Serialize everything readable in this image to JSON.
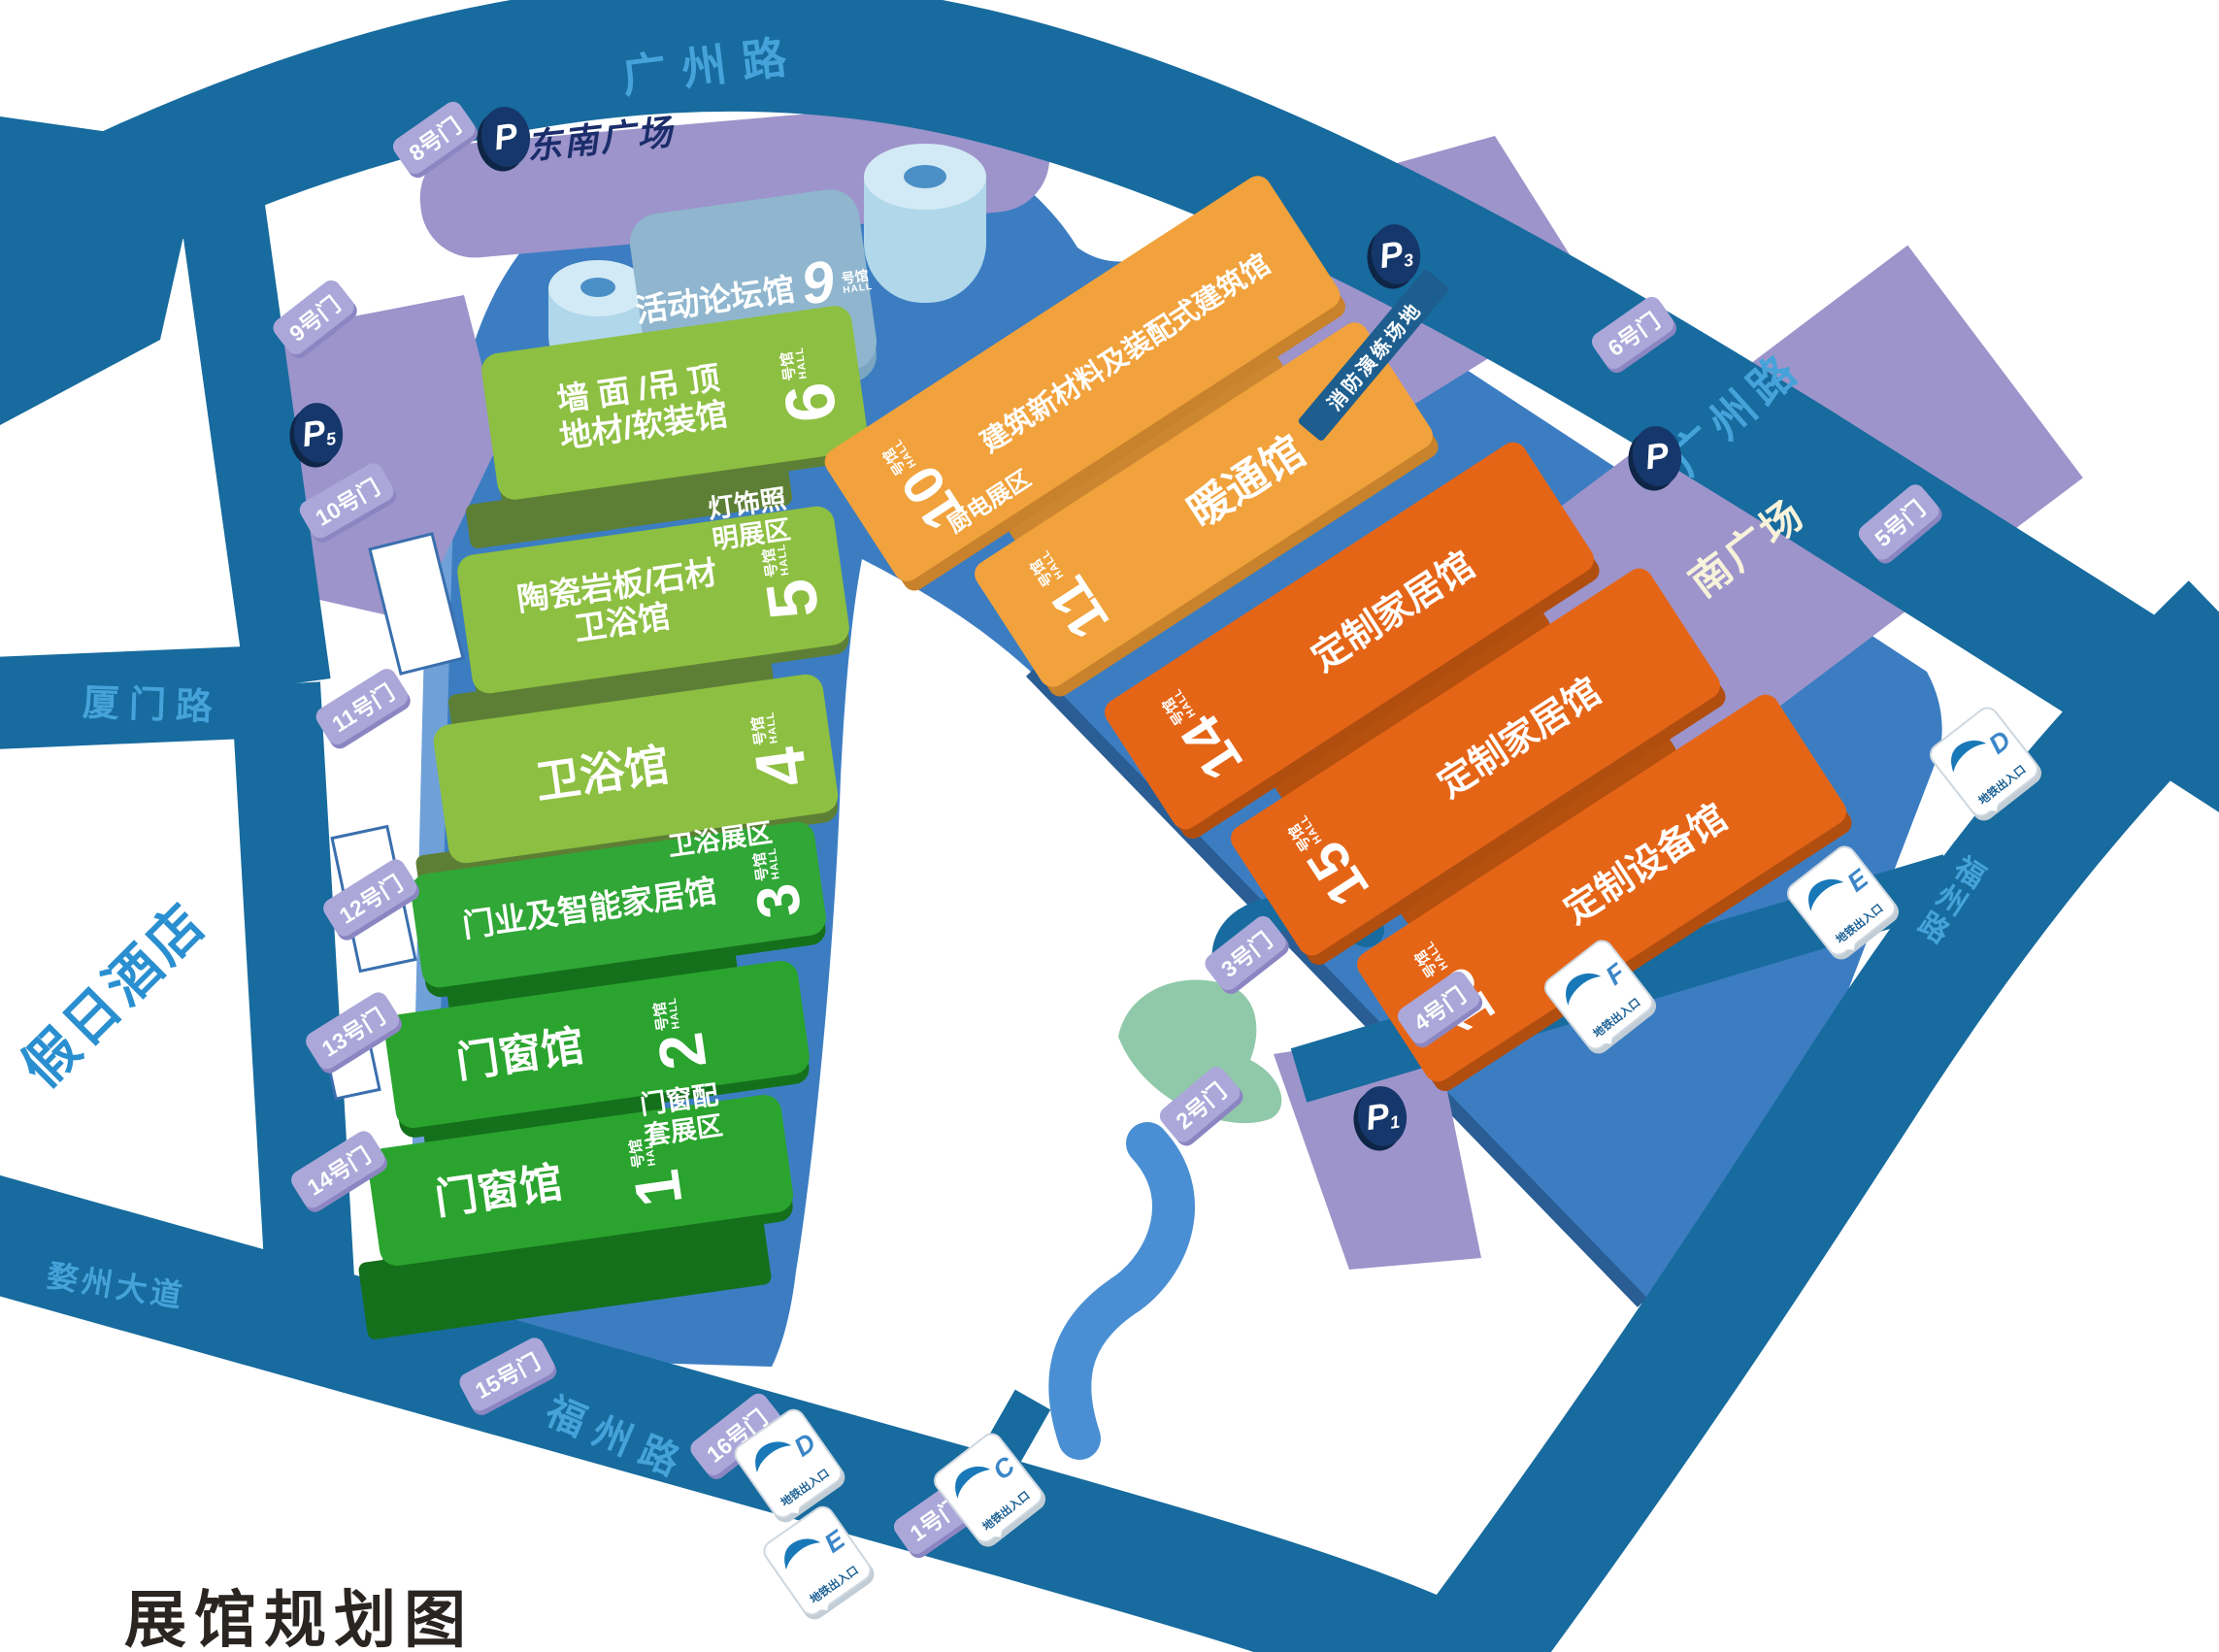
{
  "title": "展馆规划图",
  "roads": {
    "guangzhou_top": "广州路",
    "guangzhou_right": "广州路",
    "xiamen": "厦门路",
    "wuzhou": "婺州大道",
    "fuzhou_bottom": "福州路",
    "fuzhou_right": "福州路"
  },
  "hotel": "假日酒店",
  "plazas": {
    "southeast": "东南广场",
    "south": "南广场",
    "fire_drill": "消防演练场地"
  },
  "parking": [
    {
      "id": "southeast",
      "letter": "P",
      "sub": ""
    },
    {
      "id": "p5",
      "letter": "P",
      "sub": "5"
    },
    {
      "id": "p3",
      "letter": "P",
      "sub": "3"
    },
    {
      "id": "south",
      "letter": "P",
      "sub": ""
    },
    {
      "id": "p1",
      "letter": "P",
      "sub": "1"
    }
  ],
  "hall9": {
    "name": "活动论坛馆",
    "no": "9",
    "unit": "号馆",
    "hall": "HALL"
  },
  "green_halls": [
    {
      "no": "6",
      "unit": "号馆",
      "hall": "HALL",
      "line1": "墙 面 /吊 顶",
      "line2": "地材/软装馆"
    },
    {
      "no": "5",
      "unit": "号馆",
      "hall": "HALL",
      "line1": "陶瓷岩板/石材",
      "line2": "卫浴馆"
    },
    {
      "no": "4",
      "unit": "号馆",
      "hall": "HALL",
      "line1": "卫浴馆",
      "line2": ""
    },
    {
      "no": "3",
      "unit": "号馆",
      "hall": "HALL",
      "line1": "门业及智能家居馆",
      "line2": ""
    },
    {
      "no": "2",
      "unit": "号馆",
      "hall": "HALL",
      "line1": "门窗馆",
      "line2": ""
    },
    {
      "no": "1",
      "unit": "号馆",
      "hall": "HALL",
      "line1": "门窗馆",
      "line2": ""
    }
  ],
  "orange_halls": [
    {
      "no": "10",
      "unit": "号馆",
      "hall": "HALL",
      "name": "建筑新材料及装配式建筑馆"
    },
    {
      "no": "11",
      "unit": "号馆",
      "hall": "HALL",
      "name": "暖通馆"
    },
    {
      "no": "14",
      "unit": "号馆",
      "hall": "HALL",
      "name": "定制家居馆"
    },
    {
      "no": "15",
      "unit": "号馆",
      "hall": "HALL",
      "name": "定制家居馆"
    },
    {
      "no": "16",
      "unit": "号馆",
      "hall": "HALL",
      "name": "定制设备馆"
    }
  ],
  "zones": {
    "lighting1": "灯饰照",
    "lighting2": "明展区",
    "bath": "卫浴展区",
    "window1": "门窗配",
    "window2": "套展区",
    "kitchen": "厨电展区"
  },
  "gates": [
    {
      "label": "1号门"
    },
    {
      "label": "2号门"
    },
    {
      "label": "3号门"
    },
    {
      "label": "4号门"
    },
    {
      "label": "5号门"
    },
    {
      "label": "6号门"
    },
    {
      "label": "8号门"
    },
    {
      "label": "9号门"
    },
    {
      "label": "10号门"
    },
    {
      "label": "11号门"
    },
    {
      "label": "12号门"
    },
    {
      "label": "13号门"
    },
    {
      "label": "14号门"
    },
    {
      "label": "15号门"
    },
    {
      "label": "16号门"
    }
  ],
  "subway": {
    "label": "地铁出入口",
    "entrances": [
      {
        "letter": "D"
      },
      {
        "letter": "E"
      },
      {
        "letter": "F"
      },
      {
        "letter": "C"
      },
      {
        "letter": "D"
      },
      {
        "letter": "E"
      }
    ]
  }
}
